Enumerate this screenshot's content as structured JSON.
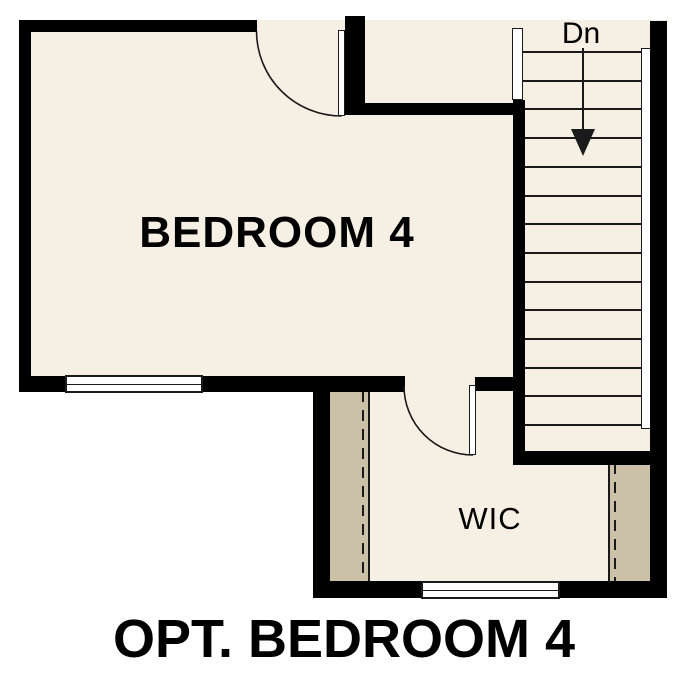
{
  "title_caption": "OPT. BEDROOM 4",
  "rooms": {
    "bedroom": {
      "label": "BEDROOM 4"
    },
    "closet": {
      "label": "WIC"
    }
  },
  "stairs": {
    "label": "Dn",
    "tread_count": 14
  },
  "symbols": {
    "down_arrow": "solid triangle arrow pointing down inside stairwell",
    "doors": [
      "bedroom entry door with quarter-circle swing",
      "wic entry door with quarter-circle swing"
    ],
    "windows": [
      "bedroom bottom-wall window",
      "wic bottom-wall window"
    ],
    "closet_rods": "dashed lines along tan shelf strips"
  },
  "colors": {
    "wall": "#000000",
    "floor": "#f6efe3",
    "shelf": "#cbc1a8",
    "background": "#ffffff",
    "line": "#1a1a1a"
  }
}
